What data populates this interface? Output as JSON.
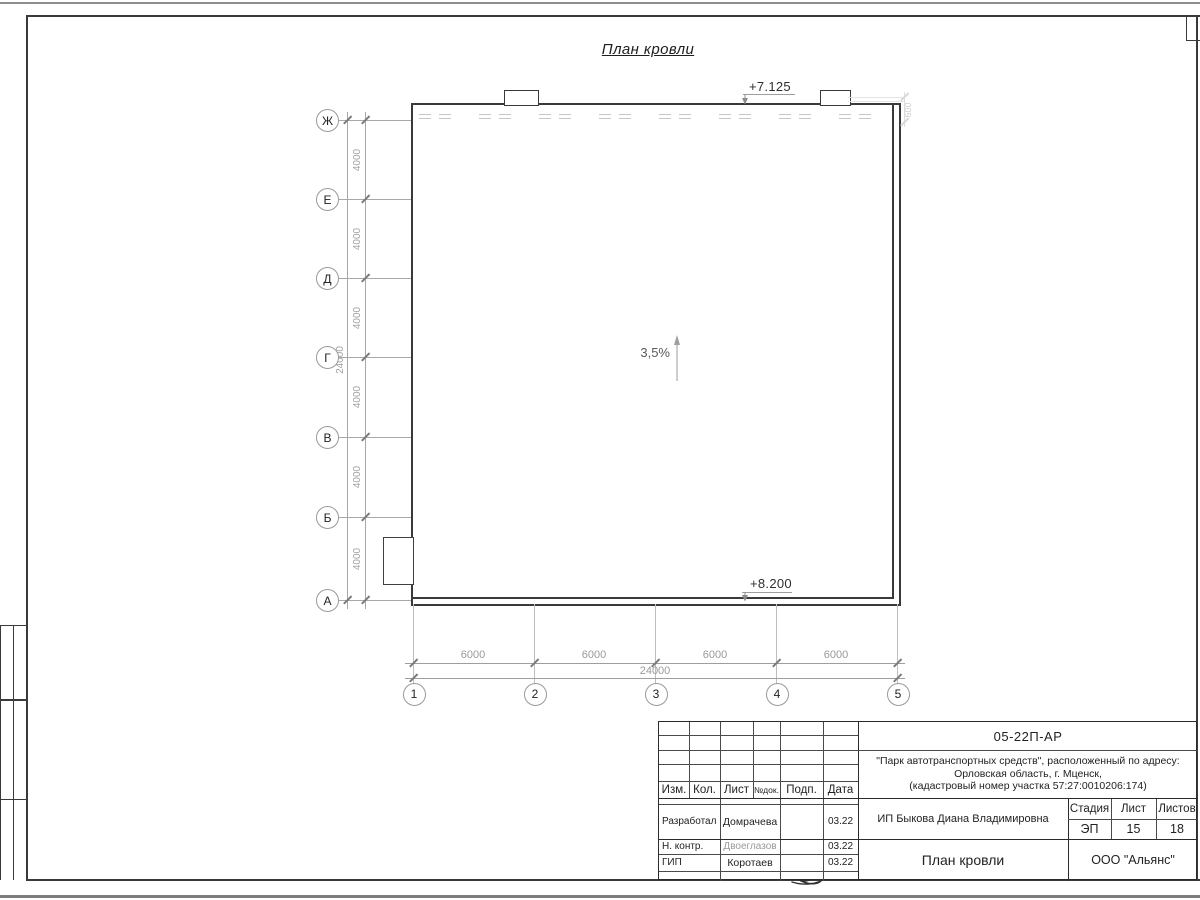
{
  "sheet": {
    "title": "План кровли"
  },
  "marks": {
    "top_elevation": "+7.125",
    "bottom_elevation": "+8.200",
    "slope": "3,5%",
    "parapet_dim": "600"
  },
  "axes": {
    "rows": [
      "Ж",
      "Е",
      "Д",
      "Г",
      "В",
      "Б",
      "А"
    ],
    "cols": [
      "1",
      "2",
      "3",
      "4",
      "5"
    ]
  },
  "dims": {
    "left_segments": [
      "4000",
      "4000",
      "4000",
      "4000",
      "4000",
      "4000"
    ],
    "left_total": "24000",
    "bottom_segments": [
      "6000",
      "6000",
      "6000",
      "6000"
    ],
    "bottom_total": "24000"
  },
  "titleblock": {
    "doc_number": "05-22П-АР",
    "project_line1": "\"Парк автотранспортных средств\",  расположенный по адресу:",
    "project_line2": "Орловская область, г. Мценск,",
    "project_line3": "(кадастровый номер участка 57:27:0010206:174)",
    "header_cols": [
      "Изм.",
      "Кол.",
      "Лист",
      "№док.",
      "Подп.",
      "Дата"
    ],
    "rows": [
      {
        "role": "Разработал",
        "name": "Домрачева",
        "date": "03.22"
      },
      {
        "role": "Н. контр.",
        "name": "Двоеглазов",
        "date": "03.22"
      },
      {
        "role": "ГИП",
        "name": "Коротаев",
        "date": "03.22"
      }
    ],
    "client": "ИП Быкова Диана Владимировна",
    "stage_label": "Стадия",
    "sheet_label": "Лист",
    "sheets_label": "Листов",
    "stage": "ЭП",
    "sheet_no": "15",
    "sheets_total": "18",
    "drawing_title": "План кровли",
    "company": "ООО \"Альянс\""
  },
  "colors": {
    "outline": "#3a3a3a",
    "dimension": "#9a9a9a",
    "faded_name": "#999999"
  }
}
